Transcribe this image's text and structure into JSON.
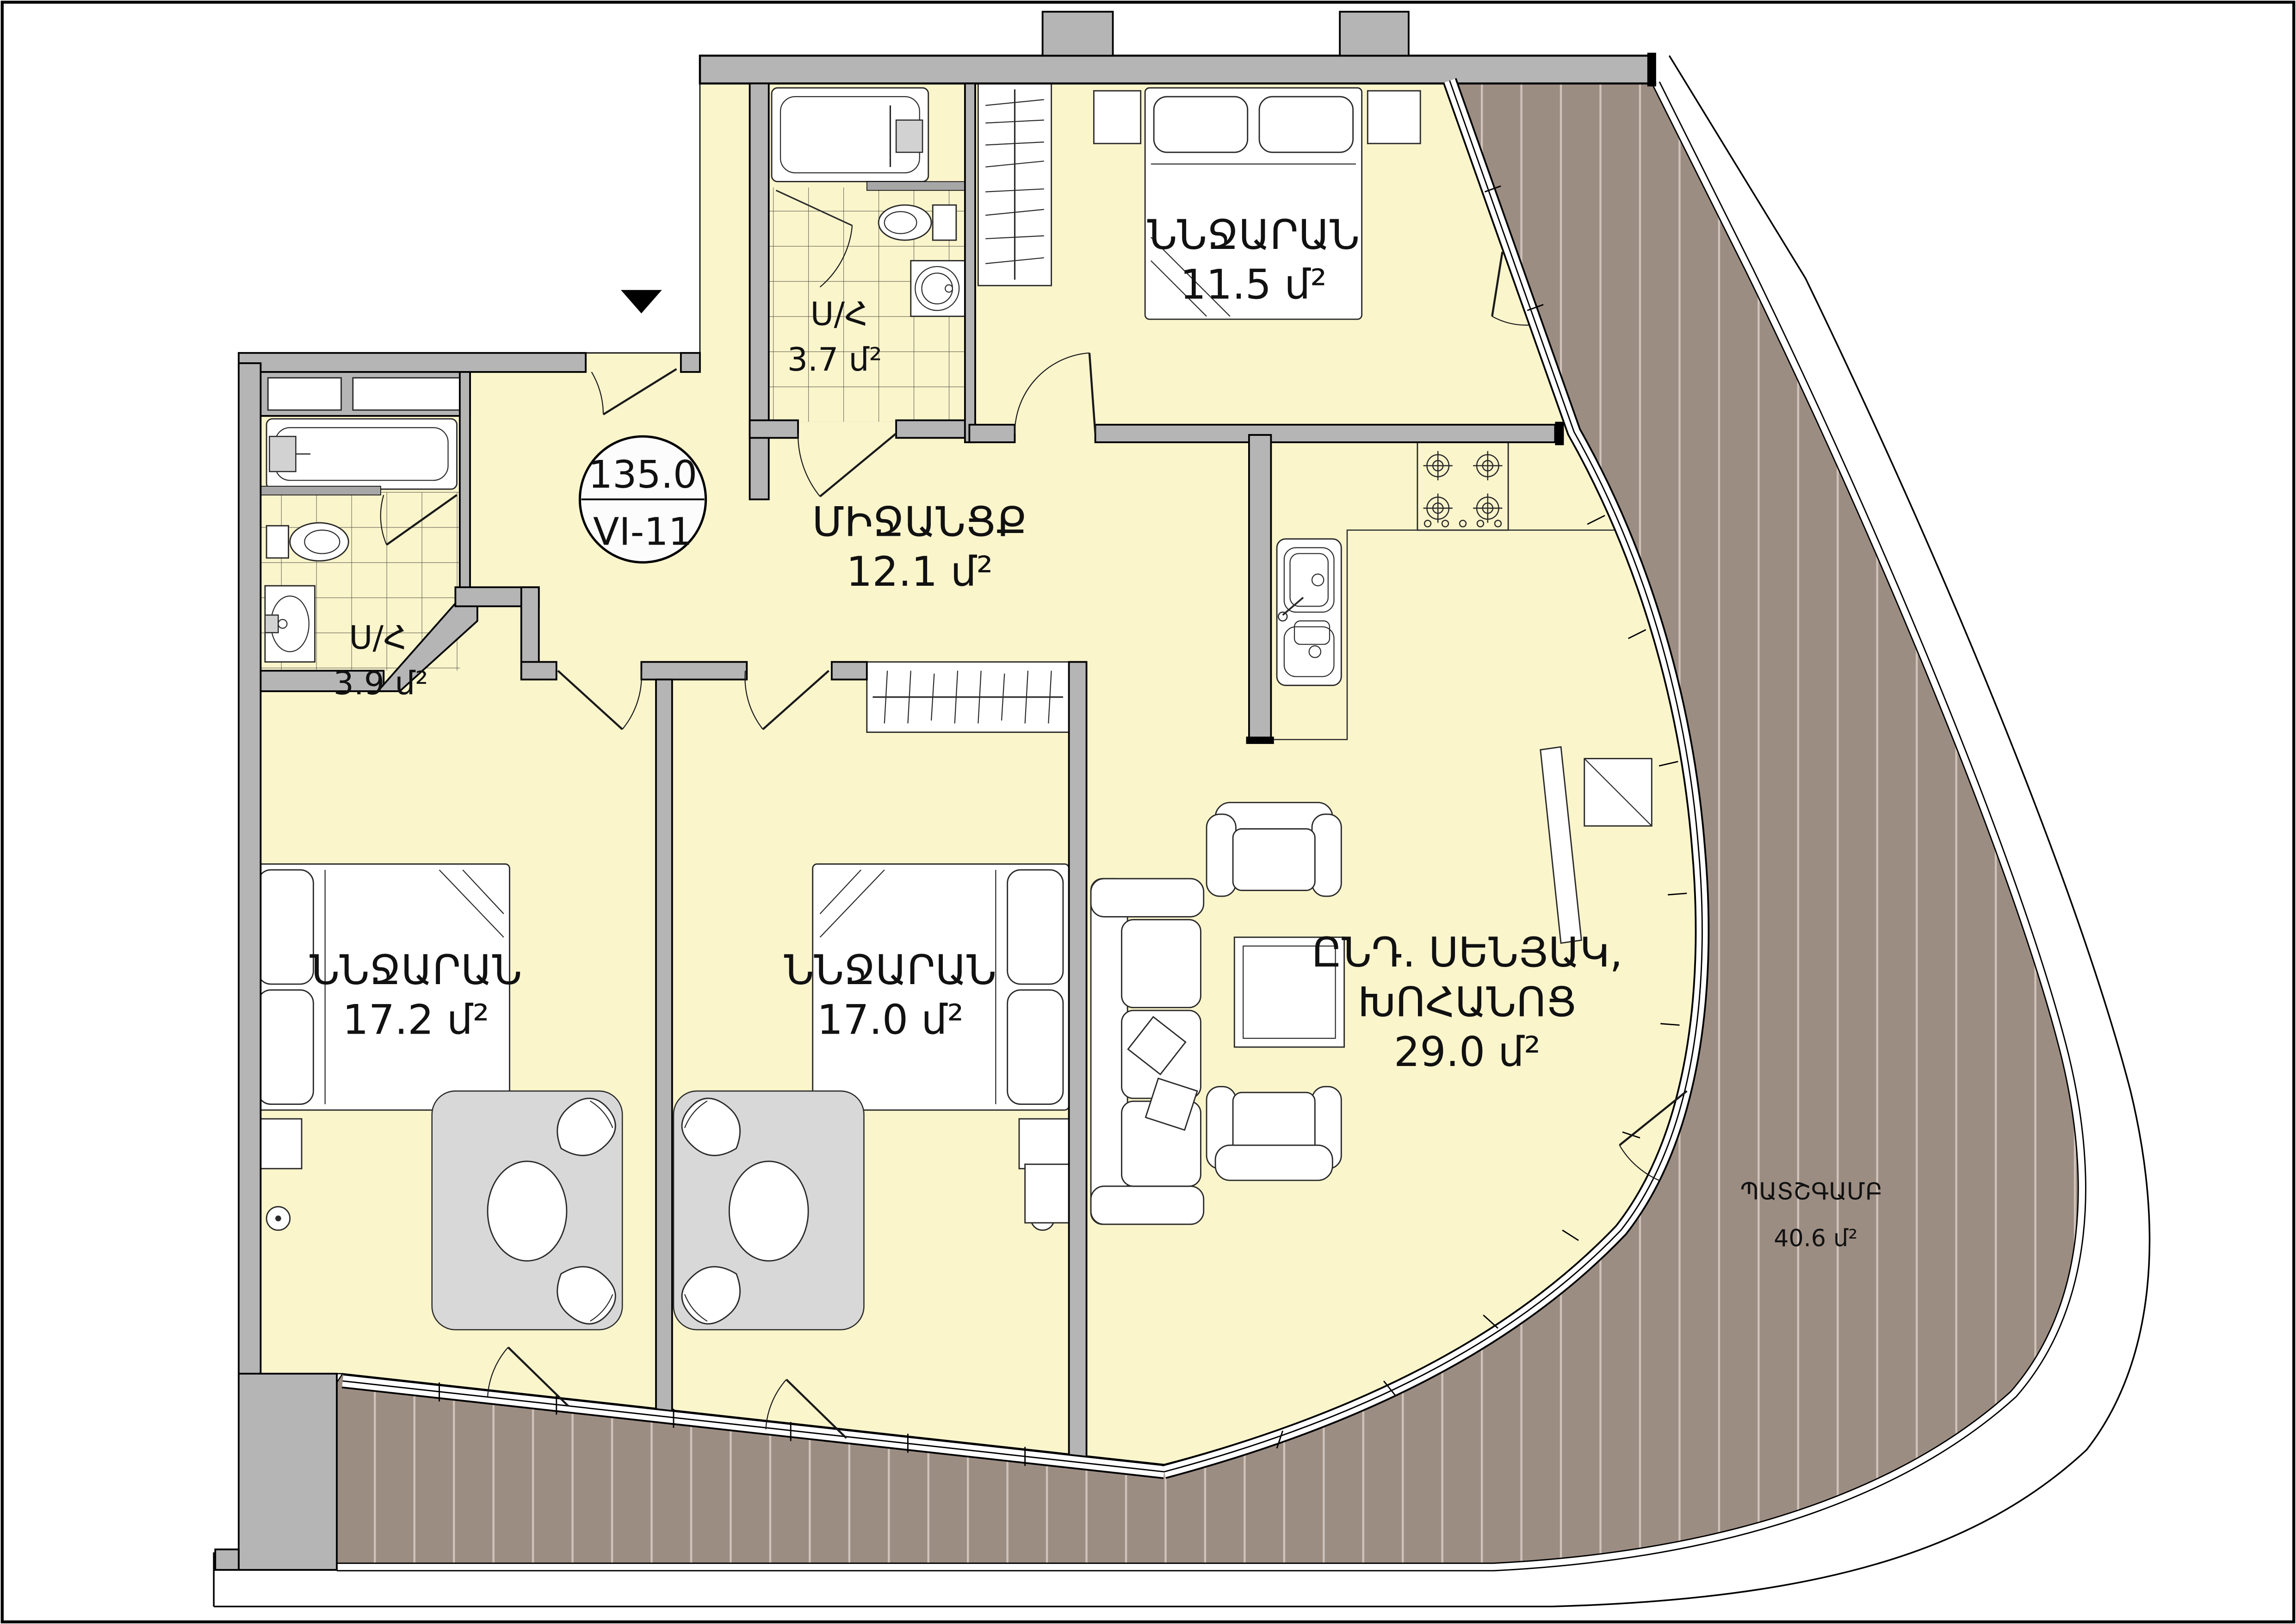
{
  "plan": {
    "badge": {
      "total_area": "135.0",
      "unit_id": "VI-11"
    },
    "rooms": [
      {
        "id": "bedroom-top",
        "name": "ՆՆՋԱՐԱՆ",
        "area": "11.5 մ²"
      },
      {
        "id": "hallway",
        "name": "ՄԻՋԱՆՑՔ",
        "area": "12.1 մ²"
      },
      {
        "id": "bathroom-top",
        "name": "Ս/Հ",
        "area": "3.7 մ²"
      },
      {
        "id": "bathroom-left",
        "name": "Ս/Հ",
        "area": "3.9 մ²"
      },
      {
        "id": "bedroom-left",
        "name": "ՆՆՋԱՐԱՆ",
        "area": "17.2 մ²"
      },
      {
        "id": "bedroom-middle",
        "name": "ՆՆՋԱՐԱՆ",
        "area": "17.0 մ²"
      },
      {
        "id": "living-kitchen",
        "name_line1": "ԸՆԴ. ՍԵՆՅԱԿ,",
        "name_line2": "ԽՈՀԱՆՈՑ",
        "area": "29.0 մ²"
      },
      {
        "id": "balcony",
        "name": "ՊԱՏՇԳԱՄԲ",
        "area": "40.6 մ²"
      }
    ],
    "colors": {
      "floor": "#FBF5CC",
      "balcony_deck": "#9C8D83",
      "deck_stripe": "#CFC3BA",
      "wall": "#B5B5B5",
      "rug": "#D8D8D8",
      "line": "#000000",
      "page": "#FFFFFF"
    }
  }
}
